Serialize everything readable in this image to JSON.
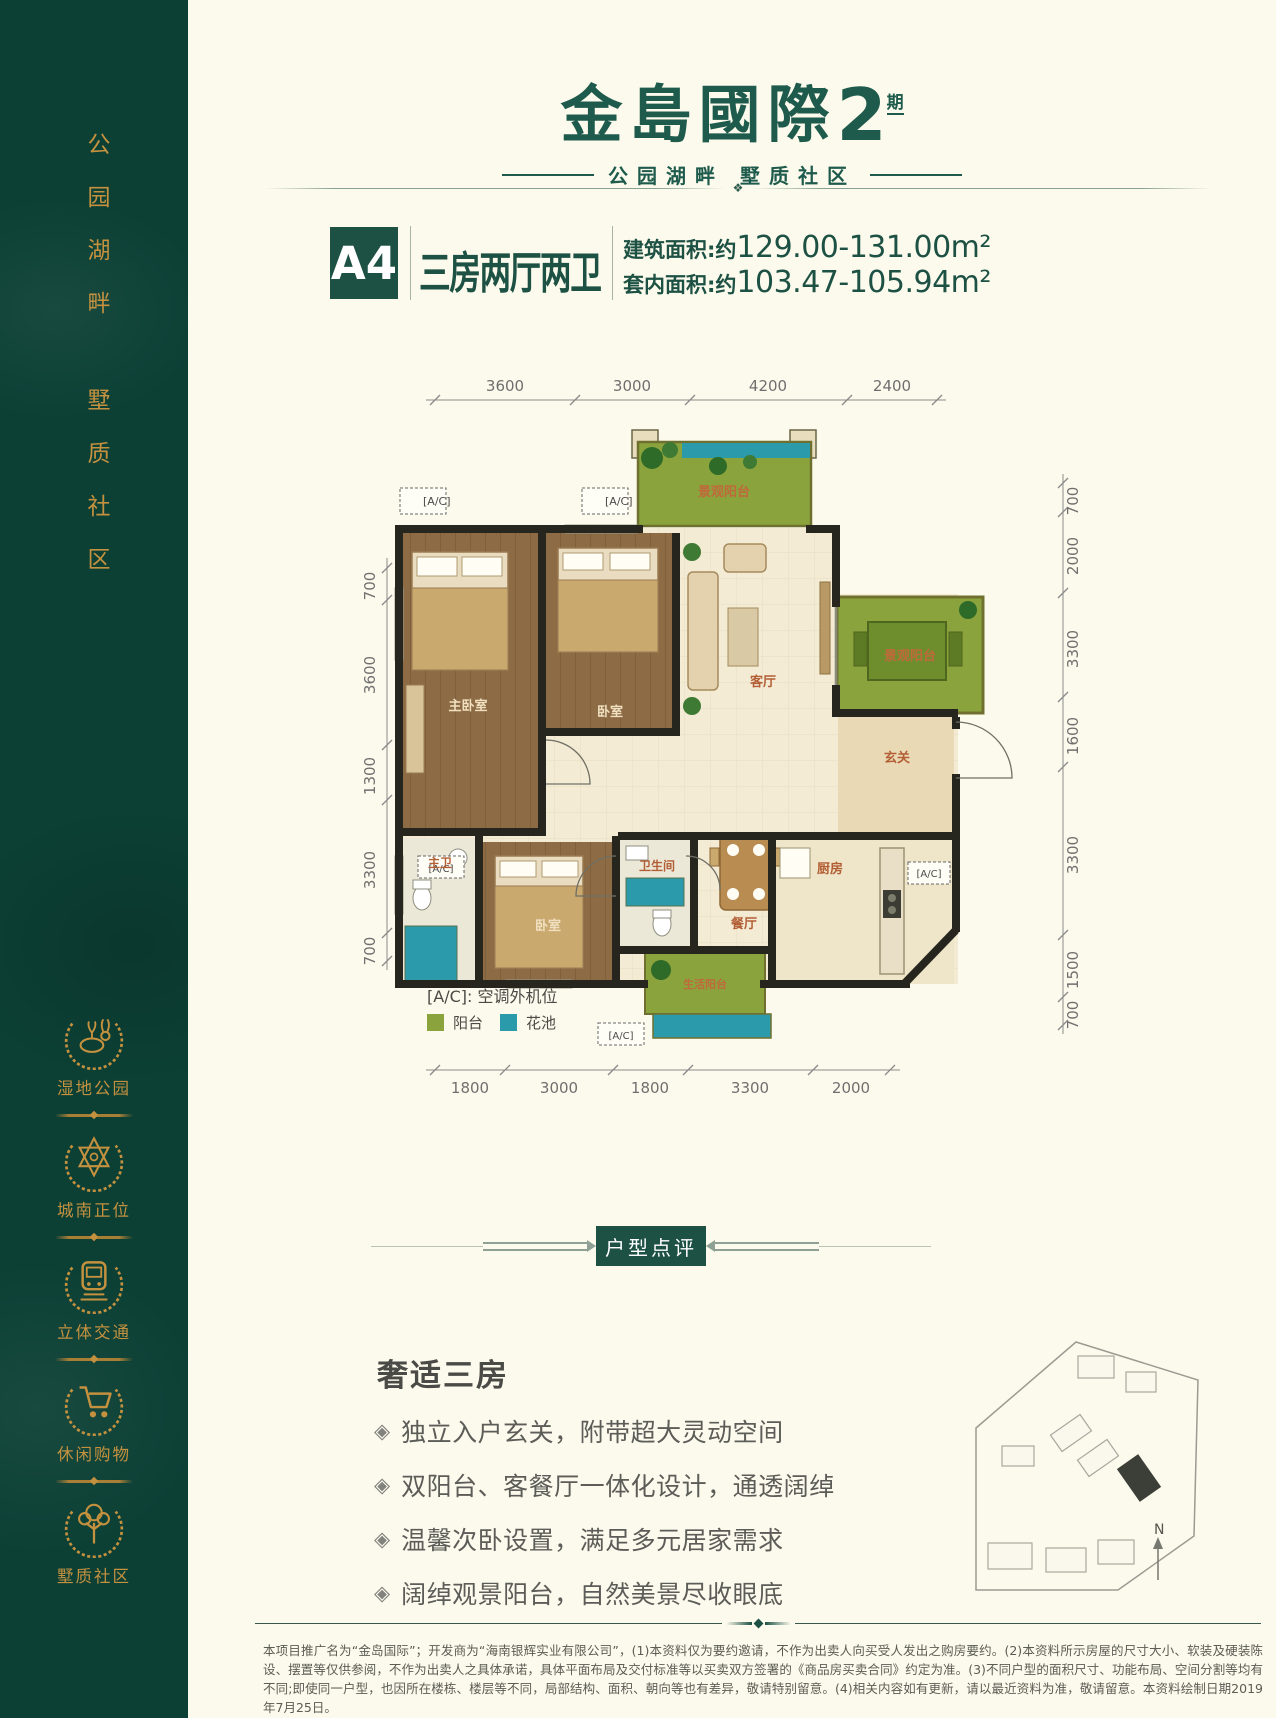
{
  "colors": {
    "brand_green": "#1d5144",
    "sidebar_green": "#0c4035",
    "gold": "#c4913f",
    "cream_bg": "#fcfaec",
    "balcony_green": "#8ba33d",
    "pond_teal": "#2b9aab",
    "room_label": "#b35f36"
  },
  "sidebar": {
    "slogan_top": "公园湖畔",
    "slogan_bottom": "墅质社区",
    "badges": [
      {
        "label": "湿地公园",
        "icon": "deer-icon"
      },
      {
        "label": "城南正位",
        "icon": "compass-star-icon"
      },
      {
        "label": "立体交通",
        "icon": "train-icon"
      },
      {
        "label": "休闲购物",
        "icon": "cart-icon"
      },
      {
        "label": "墅质社区",
        "icon": "tree-icon"
      }
    ]
  },
  "header": {
    "logo": "金島國際",
    "logo_num": "2",
    "logo_phase": "期",
    "tagline": "公园湖畔  墅质社区"
  },
  "title_block": {
    "unit": "A4",
    "layout": "三房两厅两卫",
    "area1_label": "建筑面积:约",
    "area1_value": "129.00-131.00m²",
    "area2_label": "套内面积:约",
    "area2_value": "103.47-105.94m²"
  },
  "floor_plan": {
    "dims_top": [
      "3600",
      "3000",
      "4200",
      "2400"
    ],
    "dims_left": [
      "700",
      "3600",
      "1300",
      "3300",
      "700"
    ],
    "dims_right": [
      "700",
      "2000",
      "3300",
      "1600",
      "3300",
      "1500",
      "700"
    ],
    "dims_bottom": [
      "1800",
      "3000",
      "1800",
      "3300",
      "2000"
    ],
    "rooms": {
      "balcony_top": "景观阳台",
      "living": "客厅",
      "terrace": "景观阳台",
      "foyer": "玄关",
      "master": "主卧室",
      "bed2": "卧室",
      "bed3": "卧室",
      "master_bath": "主卫",
      "bath": "卫生间",
      "dining": "餐厅",
      "kitchen": "厨房",
      "service_balcony": "生活阳台"
    },
    "ac": "[A/C]",
    "legend_ac": "[A/C]: 空调外机位",
    "legend_balcony": "阳台",
    "legend_pond": "花池"
  },
  "review": {
    "divider": "户型点评",
    "heading": "奢适三房",
    "bullets": [
      "独立入户玄关，附带超大灵动空间",
      "双阳台、客餐厅一体化设计，通透阔绰",
      "温馨次卧设置，满足多元居家需求",
      "阔绰观景阳台，自然美景尽收眼底"
    ]
  },
  "siteplan": {
    "north": "N"
  },
  "footer": {
    "disclaimer": "本项目推广名为“金岛国际”；开发商为“海南银辉实业有限公司”，(1)本资料仅为要约邀请，不作为出卖人向买受人发出之购房要约。(2)本资料所示房屋的尺寸大小、软装及硬装陈设、摆置等仅供参阅，不作为出卖人之具体承诺，具体平面布局及交付标准等以买卖双方签署的《商品房买卖合同》约定为准。(3)不同户型的面积尺寸、功能布局、空间分割等均有不同;即使同一户型，也因所在楼栋、楼层等不同，局部结构、面积、朝向等也有差异，敬请特别留意。(4)相关内容如有更新，请以最近资料为准，敬请留意。本资料绘制日期2019年7月25日。"
  }
}
